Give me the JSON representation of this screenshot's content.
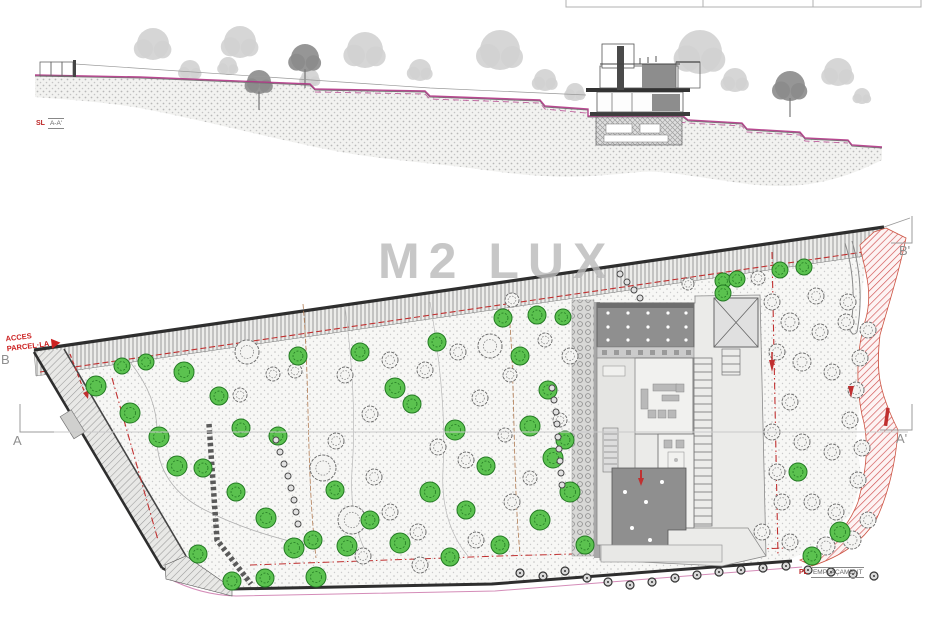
{
  "watermark": {
    "text": "M2 LUX"
  },
  "tags": {
    "section": {
      "prefix": "SL",
      "label": "A-A'"
    },
    "plan": {
      "prefix": "PL",
      "label": "EMPLAÇAMENT"
    }
  },
  "access": {
    "line1": "ACCES",
    "line2": "PARCEL·LA"
  },
  "markers": {
    "a": "A",
    "a_prime": "A'",
    "b": "B",
    "b_prime": "B'"
  },
  "colors": {
    "green_fill": "#5bc24f",
    "green_stroke": "#237a23",
    "gray_tree_stroke": "#6f6f6f",
    "gray_tree_fill": "#f4f4f2",
    "dot_fill": "#e2e2e2",
    "dot_stroke": "#4a4a4a",
    "magenta": "#b13585",
    "red": "#c03030",
    "light_canopy": "#d2d2d2",
    "dark_canopy": "#8b8b8b"
  },
  "plan": {
    "green_trees": [
      [
        96,
        386,
        10
      ],
      [
        122,
        366,
        8
      ],
      [
        146,
        362,
        8
      ],
      [
        184,
        372,
        10
      ],
      [
        219,
        396,
        9
      ],
      [
        130,
        413,
        10
      ],
      [
        159,
        437,
        10
      ],
      [
        177,
        466,
        10
      ],
      [
        203,
        468,
        9
      ],
      [
        241,
        428,
        9
      ],
      [
        278,
        436,
        9
      ],
      [
        236,
        492,
        9
      ],
      [
        266,
        518,
        10
      ],
      [
        294,
        548,
        10
      ],
      [
        198,
        554,
        9
      ],
      [
        232,
        581,
        9
      ],
      [
        265,
        578,
        9
      ],
      [
        316,
        577,
        10
      ],
      [
        313,
        540,
        9
      ],
      [
        347,
        546,
        10
      ],
      [
        400,
        543,
        10
      ],
      [
        360,
        352,
        9
      ],
      [
        298,
        356,
        9
      ],
      [
        395,
        388,
        10
      ],
      [
        412,
        404,
        9
      ],
      [
        437,
        342,
        9
      ],
      [
        455,
        430,
        10
      ],
      [
        430,
        492,
        10
      ],
      [
        466,
        510,
        9
      ],
      [
        486,
        466,
        9
      ],
      [
        520,
        356,
        9
      ],
      [
        503,
        318,
        9
      ],
      [
        537,
        315,
        9
      ],
      [
        563,
        317,
        8
      ],
      [
        548,
        390,
        9
      ],
      [
        530,
        426,
        10
      ],
      [
        553,
        458,
        10
      ],
      [
        570,
        492,
        10
      ],
      [
        540,
        520,
        10
      ],
      [
        500,
        545,
        9
      ],
      [
        450,
        557,
        9
      ],
      [
        585,
        545,
        9
      ],
      [
        565,
        440,
        9
      ],
      [
        335,
        490,
        9
      ],
      [
        370,
        520,
        9
      ],
      [
        723,
        281,
        8
      ],
      [
        737,
        279,
        8
      ],
      [
        780,
        270,
        8
      ],
      [
        804,
        267,
        8
      ],
      [
        723,
        293,
        8
      ],
      [
        798,
        472,
        9
      ],
      [
        840,
        532,
        10
      ],
      [
        812,
        556,
        9
      ]
    ],
    "gray_trees": [
      [
        247,
        352,
        12
      ],
      [
        273,
        374,
        7
      ],
      [
        295,
        371,
        7
      ],
      [
        240,
        395,
        7
      ],
      [
        323,
        468,
        13
      ],
      [
        352,
        520,
        14
      ],
      [
        374,
        477,
        8
      ],
      [
        336,
        441,
        8
      ],
      [
        370,
        414,
        8
      ],
      [
        345,
        375,
        8
      ],
      [
        390,
        360,
        8
      ],
      [
        425,
        370,
        8
      ],
      [
        458,
        352,
        8
      ],
      [
        490,
        346,
        12
      ],
      [
        510,
        375,
        7
      ],
      [
        480,
        398,
        8
      ],
      [
        466,
        460,
        8
      ],
      [
        505,
        435,
        7
      ],
      [
        438,
        447,
        8
      ],
      [
        418,
        532,
        8
      ],
      [
        390,
        512,
        8
      ],
      [
        363,
        556,
        8
      ],
      [
        420,
        565,
        8
      ],
      [
        476,
        540,
        8
      ],
      [
        512,
        502,
        8
      ],
      [
        530,
        478,
        7
      ],
      [
        512,
        300,
        7
      ],
      [
        545,
        340,
        7
      ],
      [
        570,
        356,
        8
      ],
      [
        560,
        420,
        7
      ],
      [
        688,
        284,
        6
      ],
      [
        758,
        278,
        7
      ],
      [
        772,
        302,
        8
      ],
      [
        790,
        322,
        9
      ],
      [
        820,
        332,
        8
      ],
      [
        846,
        322,
        8
      ],
      [
        777,
        352,
        8
      ],
      [
        802,
        362,
        9
      ],
      [
        832,
        372,
        8
      ],
      [
        790,
        402,
        8
      ],
      [
        772,
        432,
        8
      ],
      [
        802,
        442,
        8
      ],
      [
        832,
        452,
        8
      ],
      [
        777,
        472,
        8
      ],
      [
        782,
        502,
        8
      ],
      [
        812,
        502,
        8
      ],
      [
        836,
        512,
        8
      ],
      [
        762,
        532,
        8
      ],
      [
        790,
        542,
        8
      ],
      [
        826,
        546,
        9
      ],
      [
        852,
        540,
        9
      ],
      [
        868,
        520,
        8
      ],
      [
        858,
        480,
        8
      ],
      [
        862,
        448,
        8
      ],
      [
        850,
        420,
        8
      ],
      [
        856,
        390,
        8
      ],
      [
        860,
        358,
        8
      ],
      [
        868,
        330,
        8
      ],
      [
        848,
        302,
        8
      ],
      [
        816,
        296,
        8
      ]
    ],
    "dot_chains": [
      [
        [
          276,
          440
        ],
        [
          280,
          452
        ],
        [
          284,
          464
        ],
        [
          288,
          476
        ],
        [
          291,
          488
        ],
        [
          294,
          500
        ],
        [
          296,
          512
        ],
        [
          298,
          524
        ]
      ],
      [
        [
          552,
          388
        ],
        [
          554,
          400
        ],
        [
          556,
          412
        ],
        [
          557,
          424
        ],
        [
          558,
          437
        ],
        [
          559,
          449
        ],
        [
          560,
          461
        ],
        [
          561,
          473
        ],
        [
          562,
          485
        ]
      ],
      [
        [
          620,
          274
        ],
        [
          627,
          282
        ],
        [
          634,
          290
        ],
        [
          640,
          298
        ]
      ]
    ],
    "bottom_dots": [
      [
        520,
        573
      ],
      [
        543,
        576
      ],
      [
        565,
        571
      ],
      [
        587,
        578
      ],
      [
        608,
        582
      ],
      [
        630,
        585
      ],
      [
        652,
        582
      ],
      [
        675,
        578
      ],
      [
        697,
        575
      ],
      [
        719,
        572
      ],
      [
        741,
        570
      ],
      [
        763,
        568
      ],
      [
        786,
        566
      ],
      [
        808,
        570
      ],
      [
        831,
        572
      ],
      [
        853,
        574
      ],
      [
        874,
        576
      ]
    ],
    "pergola_dots": {
      "cols": [
        608,
        628,
        648,
        668,
        686
      ],
      "rows": [
        313,
        327,
        340
      ]
    },
    "roof_dots": [
      [
        625,
        492
      ],
      [
        646,
        502
      ],
      [
        632,
        528
      ],
      [
        662,
        482
      ],
      [
        650,
        540
      ]
    ]
  },
  "section": {
    "light_trees": [
      [
        153,
        44,
        16
      ],
      [
        190,
        70,
        10
      ],
      [
        240,
        42,
        16
      ],
      [
        228,
        66,
        9
      ],
      [
        310,
        78,
        9
      ],
      [
        365,
        50,
        18
      ],
      [
        420,
        70,
        11
      ],
      [
        500,
        50,
        20
      ],
      [
        545,
        80,
        11
      ],
      [
        575,
        92,
        9
      ],
      [
        700,
        52,
        22
      ],
      [
        735,
        80,
        12
      ],
      [
        838,
        72,
        14
      ],
      [
        862,
        96,
        8
      ]
    ],
    "dark_trees": [
      [
        259,
        82,
        12
      ],
      [
        305,
        58,
        14
      ],
      [
        790,
        86,
        15
      ]
    ]
  }
}
